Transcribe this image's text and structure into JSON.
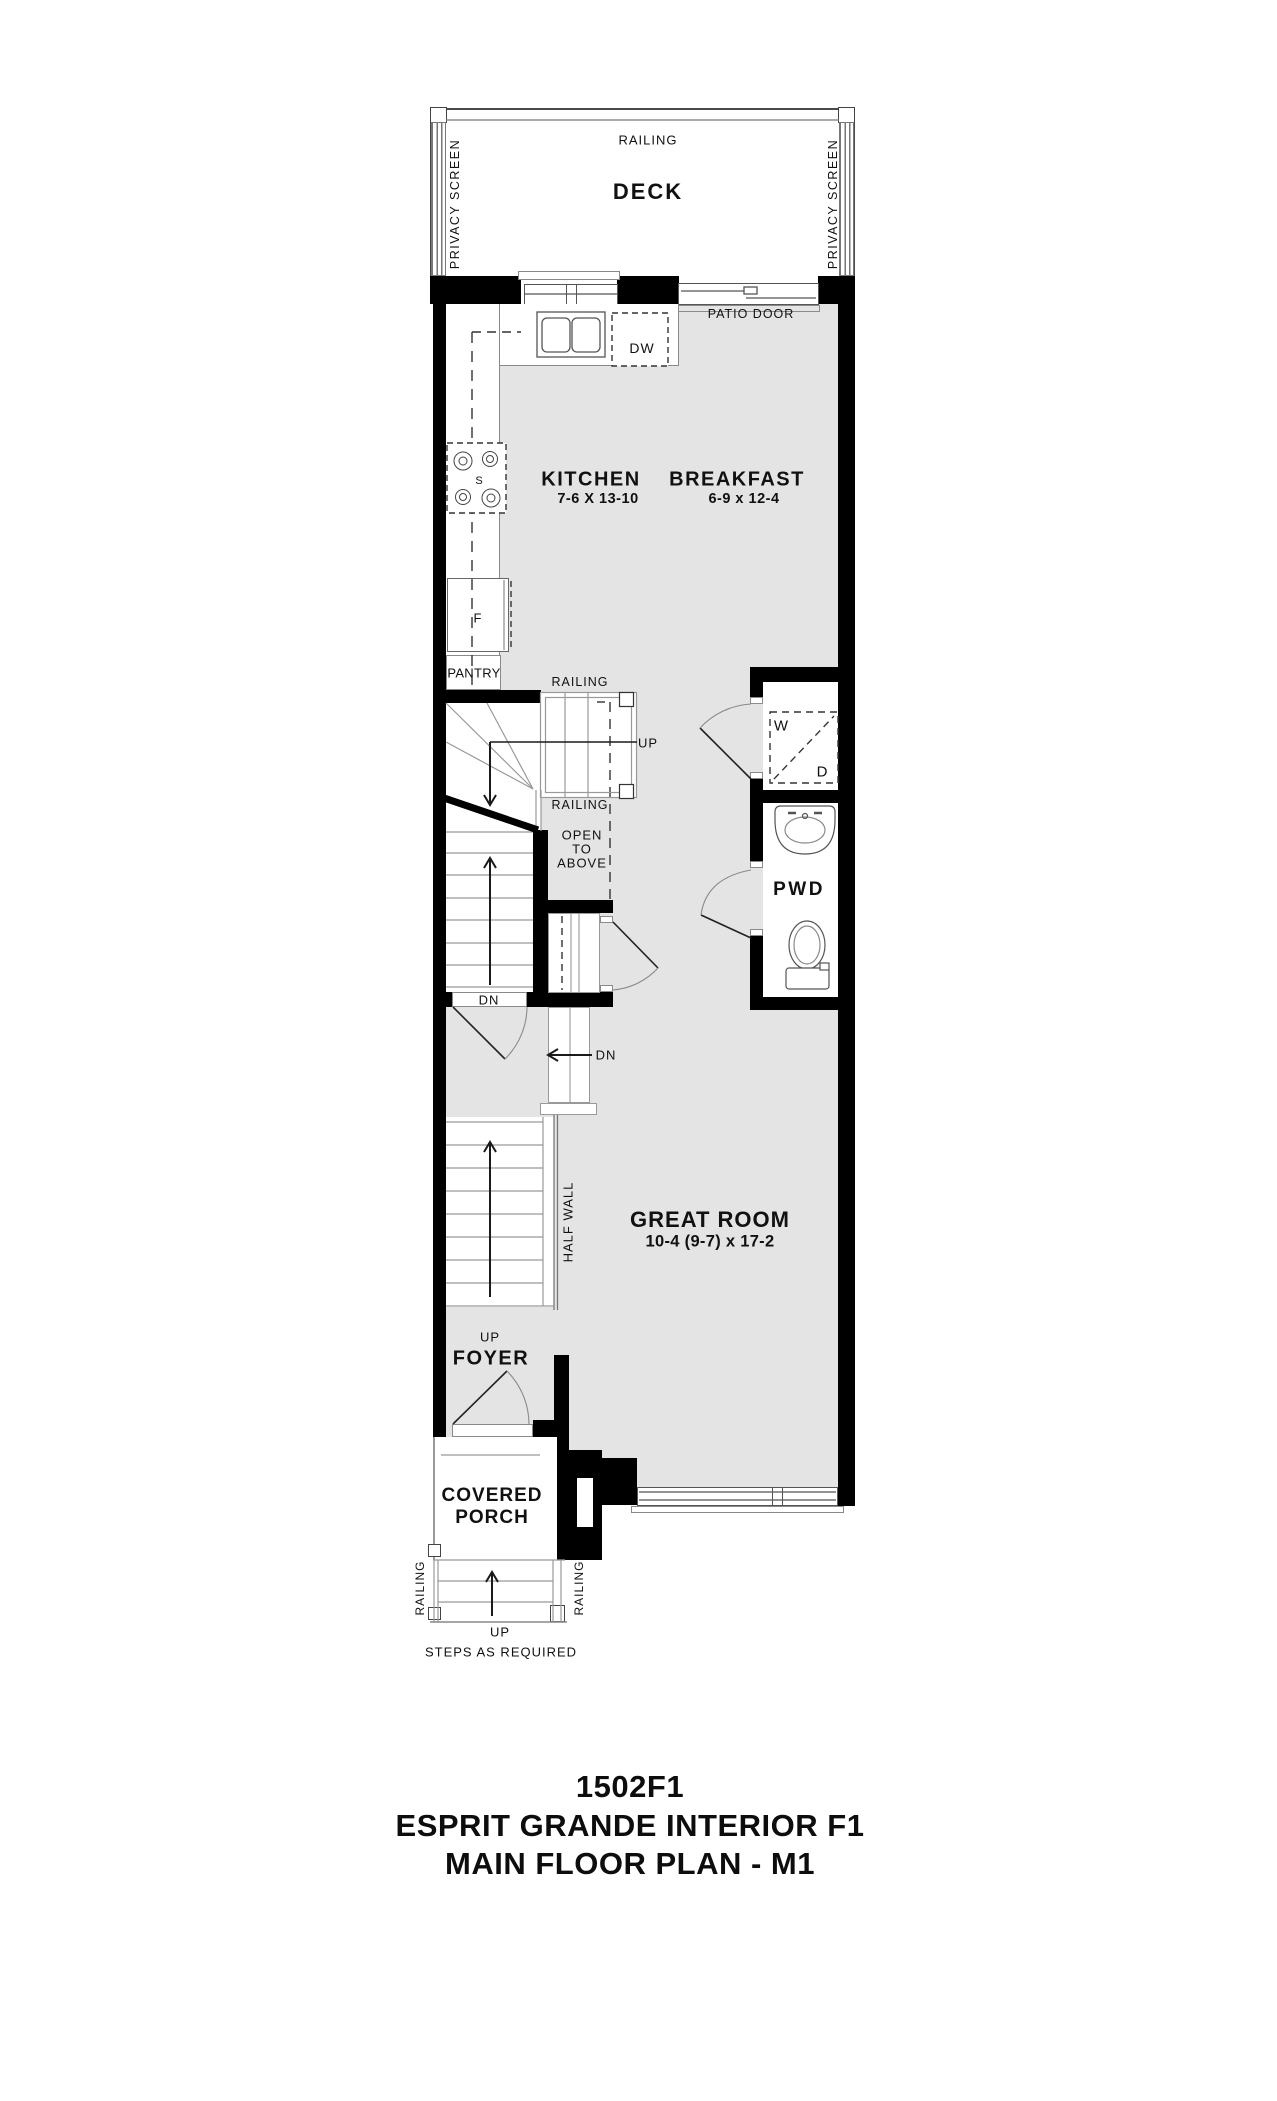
{
  "colors": {
    "wall": "#000000",
    "floor": "#e4e4e4",
    "line": "#8a8a8a",
    "accent": "#555555",
    "text": "#111111"
  },
  "deck": {
    "railing_label": "RAILING",
    "title": "DECK",
    "privacy_screen_left": "PRIVACY SCREEN",
    "privacy_screen_right": "PRIVACY SCREEN"
  },
  "kitchen": {
    "title": "KITCHEN",
    "dimensions": "7-6 X 13-10",
    "dishwasher": "DW",
    "stove": "S",
    "fridge": "F",
    "pantry": "PANTRY",
    "patio_door": "PATIO DOOR"
  },
  "breakfast": {
    "title": "BREAKFAST",
    "dimensions": "6-9 x 12-4"
  },
  "stairs": {
    "railing_upper": "RAILING",
    "railing_lower": "RAILING",
    "up_label": "UP",
    "open_line1": "OPEN",
    "open_line2": "TO",
    "open_line3": "ABOVE",
    "dn_door_label": "DN",
    "dn_arrow_label": "DN",
    "half_wall": "HALF WALL"
  },
  "laundry": {
    "washer": "W",
    "dryer": "D"
  },
  "powder_room": {
    "title": "PWD"
  },
  "great_room": {
    "title": "GREAT ROOM",
    "dimensions": "10-4 (9-7) x 17-2"
  },
  "foyer": {
    "title": "FOYER",
    "up_label": "UP"
  },
  "porch": {
    "title_line1": "COVERED",
    "title_line2": "PORCH",
    "railing_left": "RAILING",
    "railing_right": "RAILING",
    "up_label": "UP",
    "steps_note": "STEPS AS REQUIRED"
  },
  "title_block": {
    "plan_number": "1502F1",
    "plan_name": "ESPRIT GRANDE INTERIOR F1",
    "floor_name": "MAIN FLOOR PLAN - M1"
  }
}
